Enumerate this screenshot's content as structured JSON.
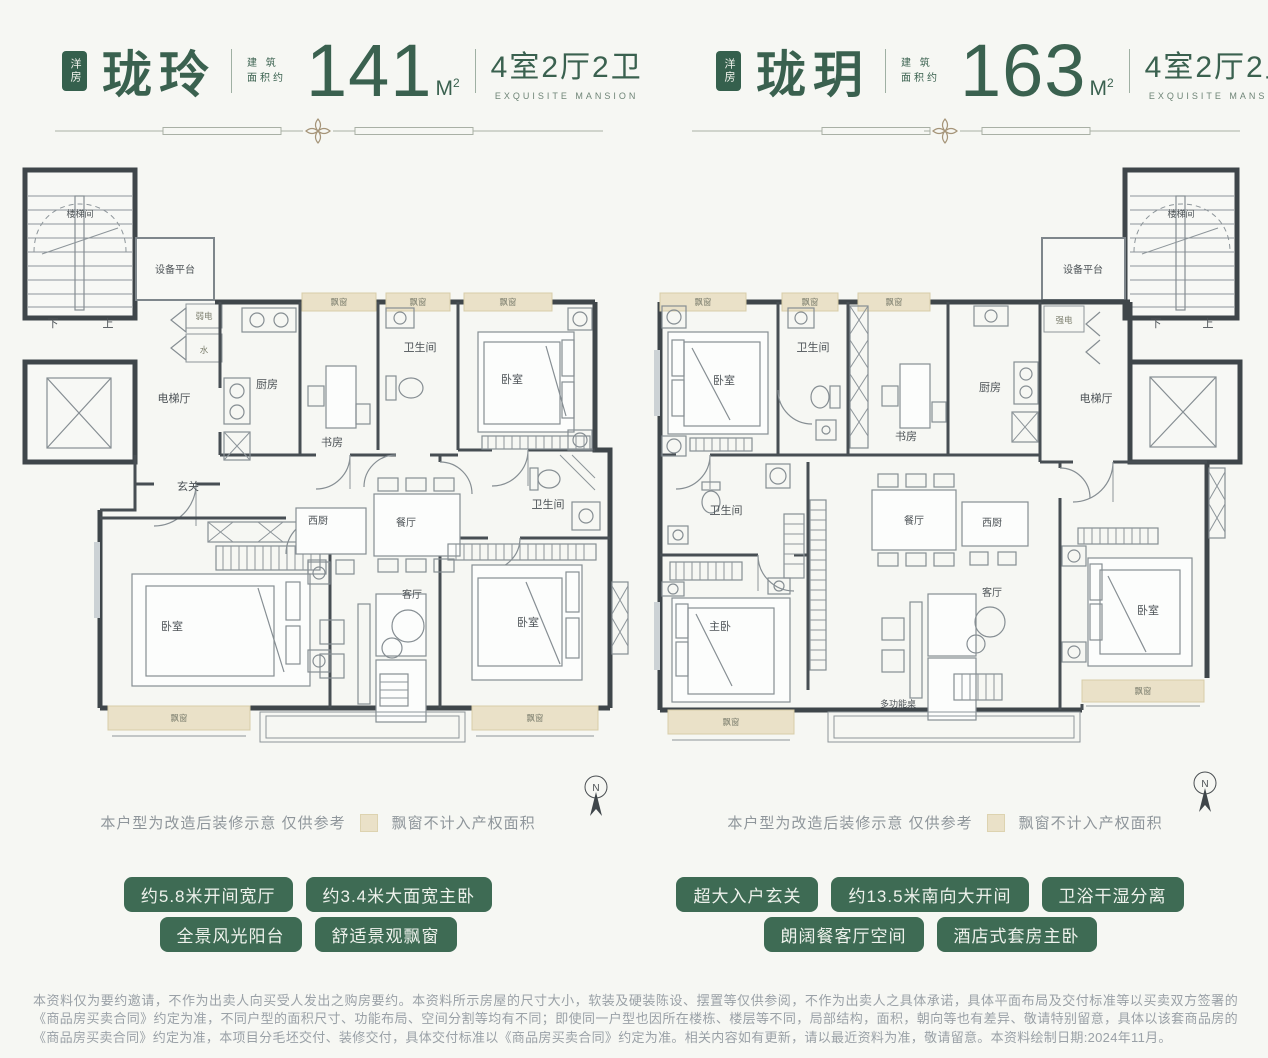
{
  "colors": {
    "brand_green": "#3a614f",
    "tag_green": "#3e6b54",
    "ornament_gold": "#a59478",
    "bay_beige": "#eae1c8",
    "wall_dark": "#3f464a",
    "page_bg": "#f6f7f3"
  },
  "units": {
    "left": {
      "badge": "洋房",
      "name": "珑玲",
      "area_label_line1": "建 筑",
      "area_label_line2": "面积约",
      "area": "141",
      "area_unit_main": "M",
      "area_unit_sup": "2",
      "layout": "4室2厅2卫",
      "layout_sub": "EXQUISITE MANSION"
    },
    "right": {
      "badge": "洋房",
      "name": "珑玥",
      "area_label_line1": "建 筑",
      "area_label_line2": "面积约",
      "area": "163",
      "area_unit_main": "M",
      "area_unit_sup": "2",
      "layout": "4室2厅2卫",
      "layout_sub": "EXQUISITE MANSION"
    }
  },
  "rooms": {
    "stair": "楼梯间",
    "equip": "设备平台",
    "down": "下",
    "up": "上",
    "elevator_hall": "电梯厅",
    "weak_elec": "弱电",
    "water": "水",
    "strong_elec": "强电",
    "kitchen": "厨房",
    "west_kitchen": "西厨",
    "study": "书房",
    "bath": "卫生间",
    "bed": "卧室",
    "master_bed": "主卧",
    "foyer": "玄关",
    "dining": "餐厅",
    "living": "客厅",
    "multi_table": "多功能桌",
    "bay": "飘窗"
  },
  "compass": {
    "n": "N"
  },
  "legend": {
    "note": "本户型为改造后装修示意 仅供参考",
    "bay_note": "飘窗不计入产权面积"
  },
  "tags": {
    "left_row1": [
      "约5.8米开间宽厅",
      "约3.4米大面宽主卧"
    ],
    "left_row2": [
      "全景风光阳台",
      "舒适景观飘窗"
    ],
    "right_row1": [
      "超大入户玄关",
      "约13.5米南向大开间",
      "卫浴干湿分离"
    ],
    "right_row2": [
      "朗阔餐客厅空间",
      "酒店式套房主卧"
    ]
  },
  "disclaimer": "本资料仅为要约邀请，不作为出卖人向买受人发出之购房要约。本资料所示房屋的尺寸大小，软装及硬装陈设、摆置等仅供参阅，不作为出卖人之具体承诺，具体平面布局及交付标准等以买卖双方签署的《商品房买卖合同》约定为准，不同户型的面积尺寸、功能布局、空间分割等均有不同；即使同一户型也因所在楼栋、楼层等不同，局部结构，面积，朝向等也有差异、敬请特别留意，具体以该套商品房的《商品房买卖合同》约定为准，本项目分毛坯交付、装修交付，具体交付标准以《商品房买卖合同》约定为准。相关内容如有更新，请以最近资料为准，敬请留意。本资料绘制日期:2024年11月。"
}
